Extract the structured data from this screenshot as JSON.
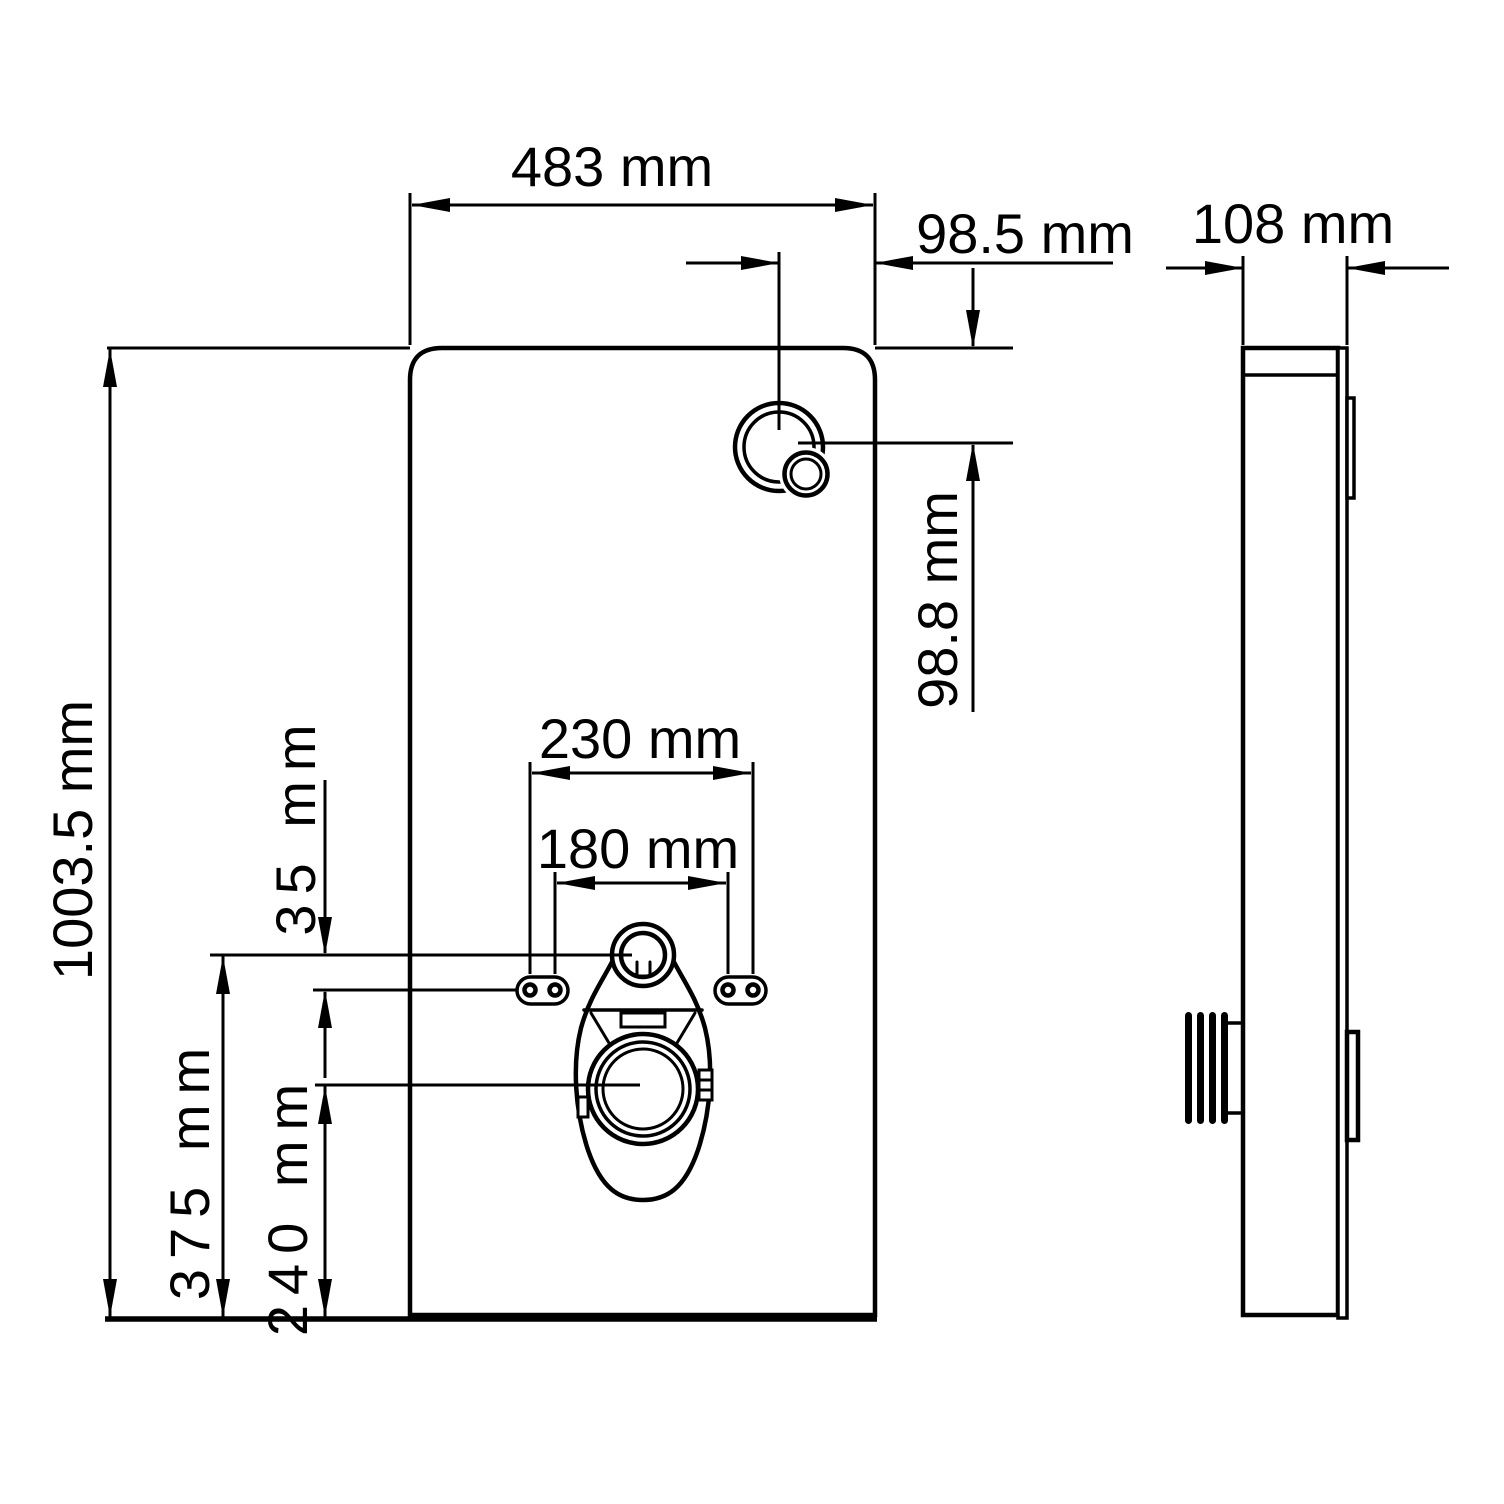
{
  "drawing": {
    "background_color": "#ffffff",
    "line_color": "#000000",
    "views": {
      "front": {
        "labels": {
          "panel_width": "483 mm",
          "panel_height": "1003.5 mm",
          "button_from_right": "98.5 mm",
          "button_from_top": "98.8 mm",
          "holes_outer_spacing": "230 mm",
          "holes_inner_spacing": "180 mm",
          "inlet_above_holes": "35 mm",
          "inlet_center_height": "375 mm",
          "outlet_center_height": "240 mm"
        }
      },
      "side": {
        "labels": {
          "depth": "108 mm"
        }
      }
    }
  }
}
